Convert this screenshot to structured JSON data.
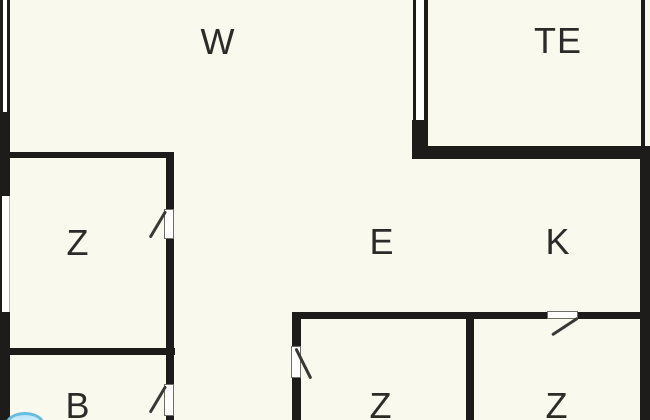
{
  "plan": {
    "type": "floor-plan",
    "rooms": [
      {
        "id": "top-left-room",
        "label": "W"
      },
      {
        "id": "top-right-room",
        "label": "TE"
      },
      {
        "id": "middle-left-room",
        "label": "Z"
      },
      {
        "id": "center-room",
        "label": "E"
      },
      {
        "id": "middle-right-room",
        "label": "K"
      },
      {
        "id": "bottom-left-room",
        "label": "B"
      },
      {
        "id": "bottom-middle-room",
        "label": "Z"
      },
      {
        "id": "bottom-right-room",
        "label": "Z"
      }
    ],
    "colors": {
      "background": "#FAF9EE",
      "wall": "#1E1C1A",
      "label": "#2D2B28",
      "window": "#FFFFFF",
      "fixture_fill": "#BCE5F6",
      "fixture_stroke": "#68BCE0"
    }
  }
}
